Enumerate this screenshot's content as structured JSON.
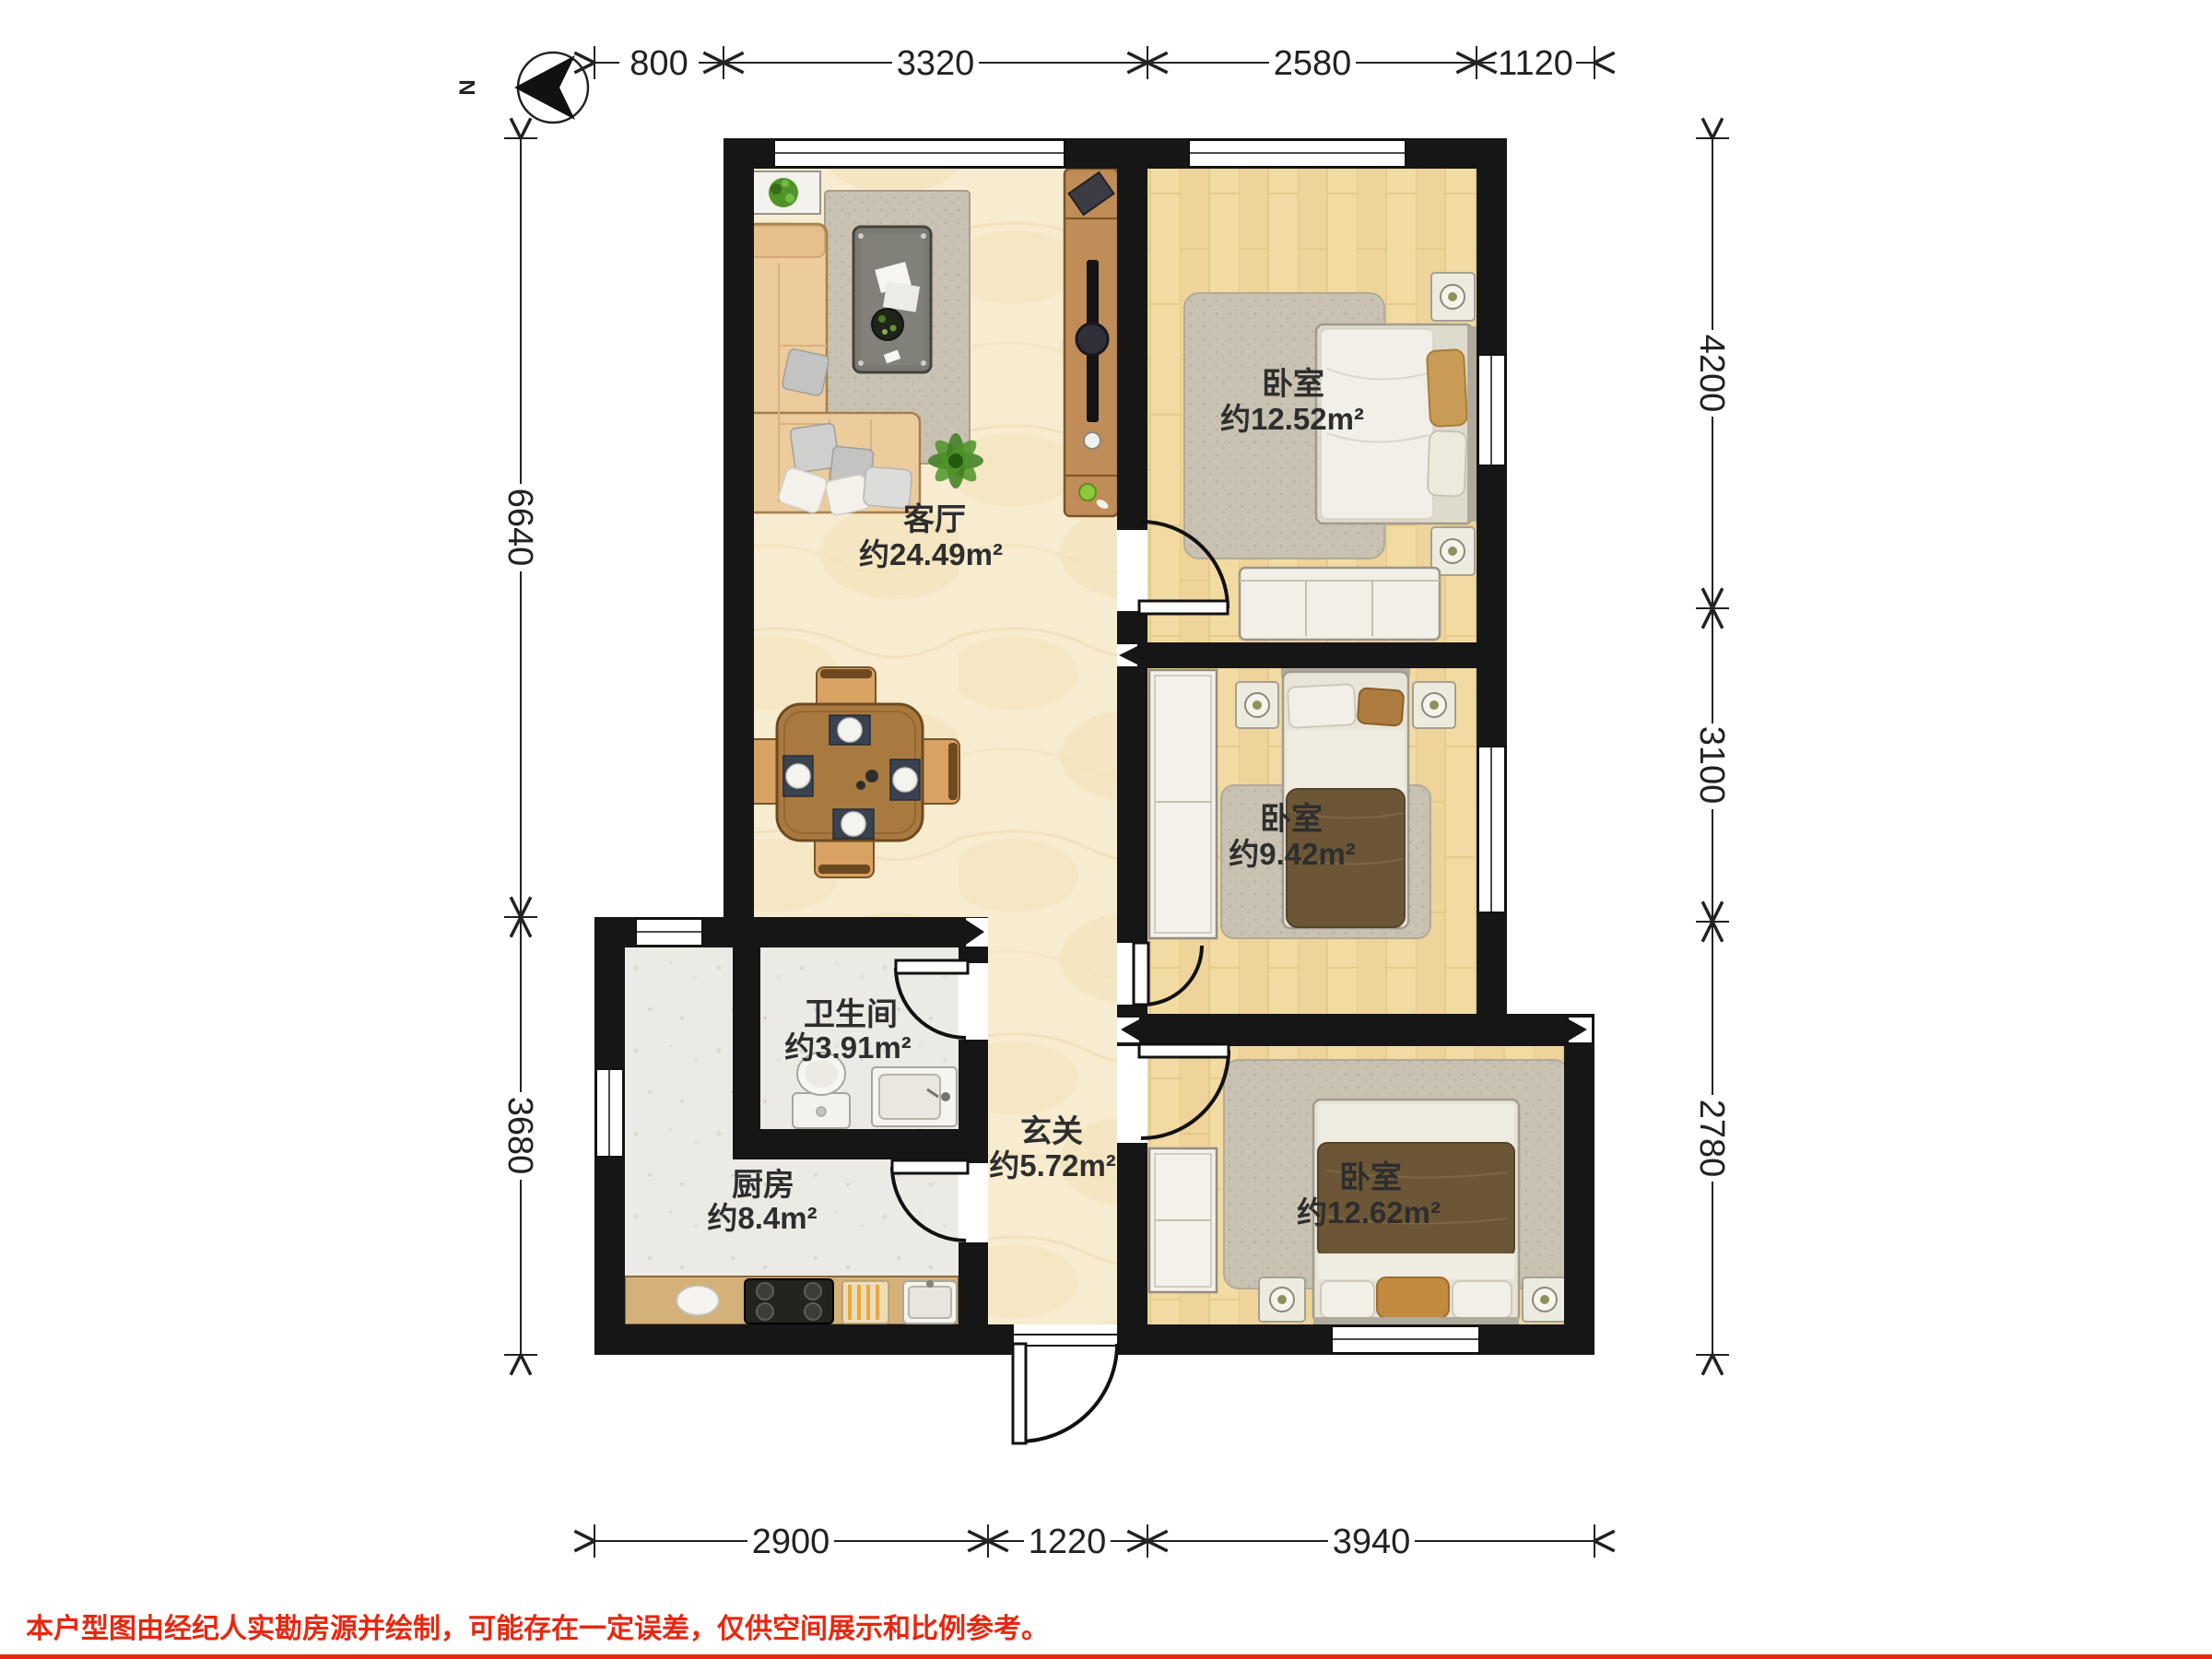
{
  "page": {
    "north_label": "N",
    "disclaimer": "本户型图由经纪人实勘房源并绘制，可能存在一定误差，仅供空间展示和比例参考。"
  },
  "rooms": {
    "living": {
      "name": "客厅",
      "area": "约24.49m²"
    },
    "bedroom_top": {
      "name": "卧室",
      "area": "约12.52m²"
    },
    "bedroom_middle": {
      "name": "卧室",
      "area": "约9.42m²"
    },
    "bedroom_bottom": {
      "name": "卧室",
      "area": "约12.62m²"
    },
    "bathroom": {
      "name": "卫生间",
      "area": "约3.91m²"
    },
    "kitchen": {
      "name": "厨房",
      "area": "约8.4m²"
    },
    "foyer": {
      "name": "玄关",
      "area": "约5.72m²"
    }
  },
  "dimensions_mm": {
    "top": [
      "800",
      "3320",
      "2580",
      "1120"
    ],
    "bottom": [
      "2900",
      "1220",
      "3940"
    ],
    "left": [
      "6640",
      "3680"
    ],
    "right": [
      "4200",
      "3100",
      "2780"
    ]
  },
  "colors": {
    "wall": "#161616",
    "marble_floor": "#f7ecd0",
    "wood_floor": "#f2dba2",
    "tile_floor": "#eceae4",
    "accent_red": "#e8270f"
  }
}
